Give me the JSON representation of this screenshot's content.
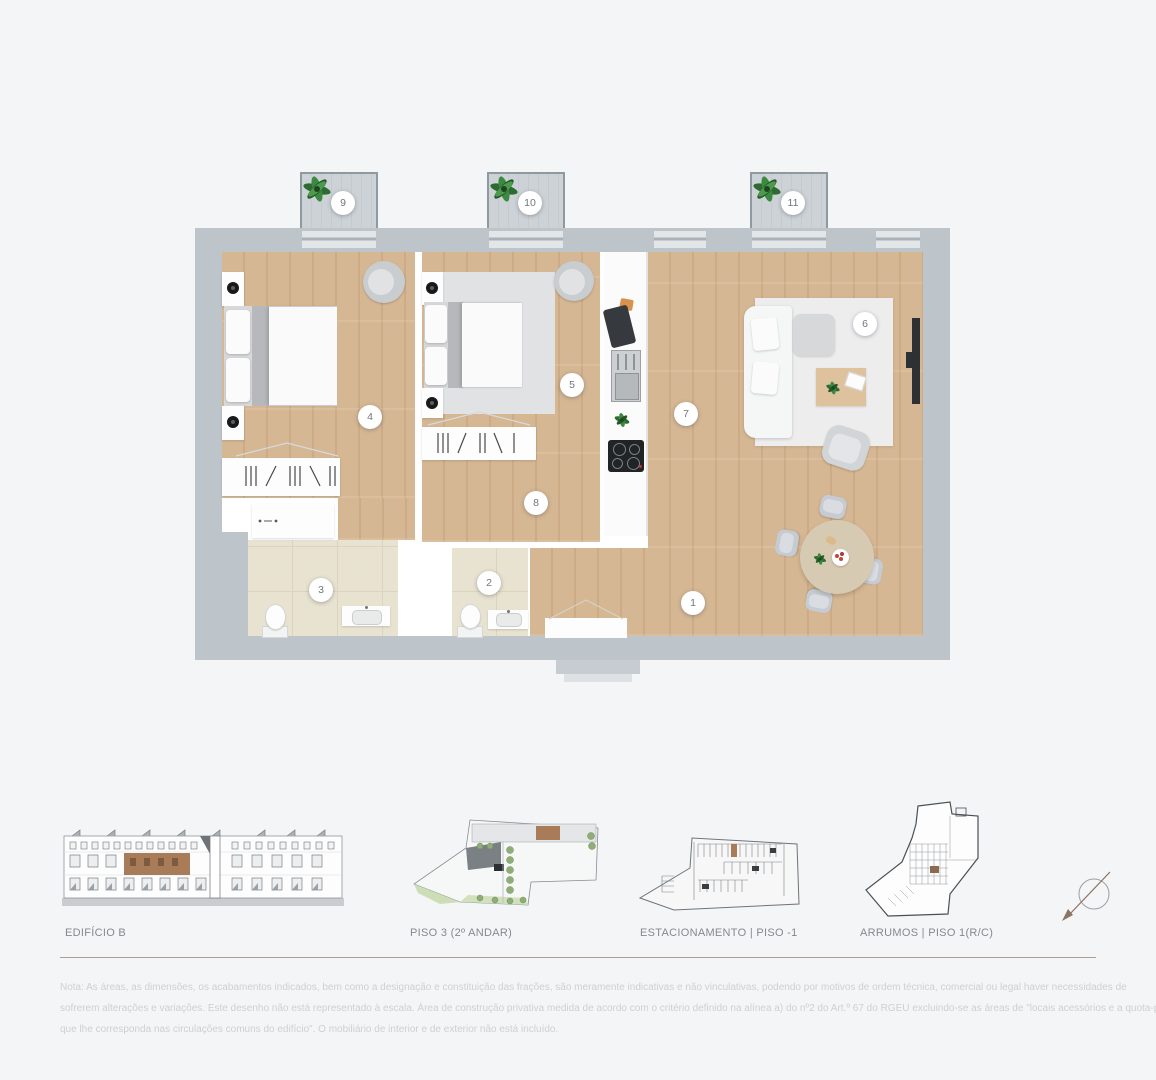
{
  "plan": {
    "room_numbers": [
      "1",
      "2",
      "3",
      "4",
      "5",
      "6",
      "7",
      "8",
      "9",
      "10",
      "11"
    ]
  },
  "legend": {
    "items": [
      {
        "label": "EDIFÍCIO B"
      },
      {
        "label": "PISO 3 (2º ANDAR)"
      },
      {
        "label": "ESTACIONAMENTO  |  PISO -1"
      },
      {
        "label": "ARRUMOS  |  PISO 1(R/C)"
      }
    ]
  },
  "note": {
    "line1": "Nota: As áreas, as dimensões, os acabamentos indicados, bem como a designação e constituição das frações, são meramente indicativas e não vinculativas, podendo por motivos de ordem técnica, comercial ou legal haver necessidades de",
    "line2": "sofrerem alterações e variações. Este desenho não está representado à escala. Área de construção privativa medida de acordo com o critério definido na alínea a) do nº2 do Art.º 67 do RGEU excluindo-se as áreas de \"locais acessórios e a quota-parte",
    "line3": "que lhe corresponda nas circulações comuns do edifício\". O mobiliário de interior e de exterior não está incluído."
  },
  "colors": {
    "highlight_brown": "#a87c58",
    "wall_gray": "#bdc4ca",
    "wood_floor": "#d3b28f",
    "tile_beige": "#e8e2d0",
    "balcony_deck": "#cdd2d6",
    "divider_line": "#b29e90",
    "plant_green": "#2f6b33"
  },
  "icons": {
    "balcony_plant": "plant-icon",
    "orientation": "compass-icon"
  }
}
